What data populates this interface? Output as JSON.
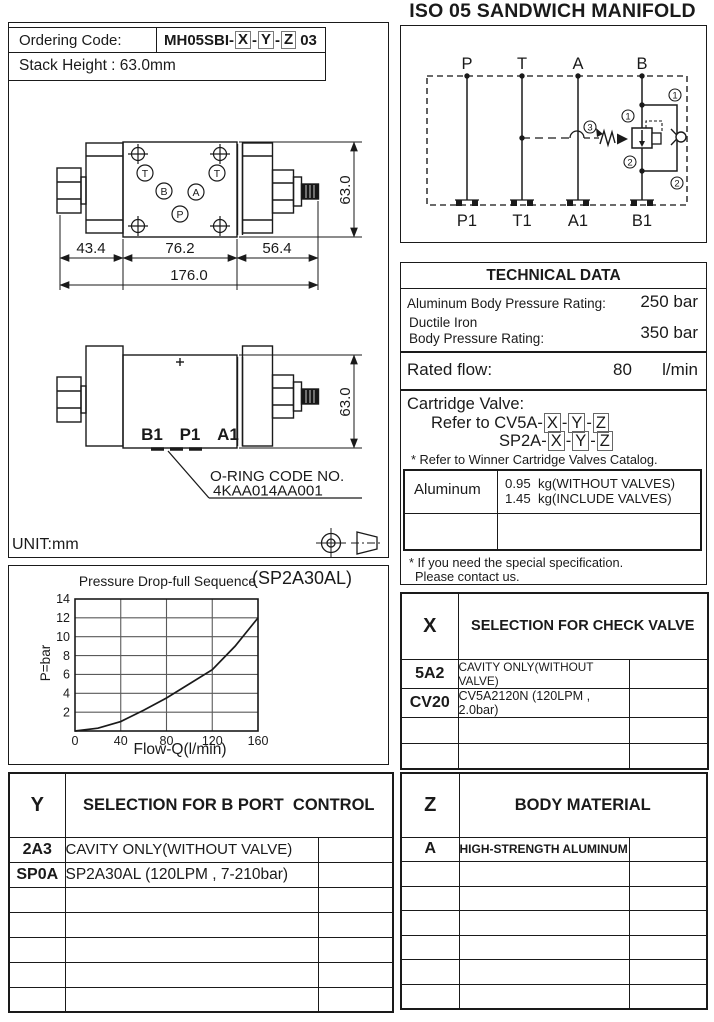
{
  "colors": {
    "ink": "#1a1a1a",
    "grid_line": "#5a5a5a"
  },
  "title": "ISO 05 SANDWICH MANIFOLD",
  "unit_label": "UNIT:mm",
  "codes": {
    "x": "X",
    "y": "Y",
    "z": "Z",
    "sep": "-"
  },
  "ordering": {
    "label": "Ordering Code:",
    "prefix": "MH05SBI-",
    "suffix": "03",
    "stack_height": "Stack Height : 63.0mm"
  },
  "schematic": {
    "top_ports": [
      "P",
      "T",
      "A",
      "B"
    ],
    "bottom_ports": [
      "P1",
      "T1",
      "A1",
      "B1"
    ],
    "callout_1": "1",
    "callout_2": "2",
    "callout_3": "3"
  },
  "drawing_top": {
    "port_t_left": "T",
    "port_t_right": "T",
    "port_b": "B",
    "port_a": "A",
    "port_p": "P",
    "dim_left": "43.4",
    "dim_mid": "76.2",
    "dim_right": "56.4",
    "dim_total": "176.0",
    "dim_height": "63.0"
  },
  "drawing_front": {
    "port_b1": "B1",
    "port_p1": "P1",
    "port_a1": "A1",
    "dim_height": "63.0",
    "oring_label": "O-RING CODE NO.",
    "oring_code": "4KAA014AA001"
  },
  "technical_data": {
    "title": "TECHNICAL DATA",
    "row1_label": "Aluminum Body Pressure Rating:",
    "row1_value": "250 bar",
    "row2_label_line1": "Ductile Iron",
    "row2_label_line2": "Body Pressure Rating:",
    "row2_value": "350 bar",
    "row3_label": "Rated flow:",
    "row3_value": "80",
    "row3_unit": "l/min",
    "cartridge_label": "Cartridge Valve:",
    "cartridge_ref1_prefix": "Refer to CV5A-",
    "cartridge_ref2_prefix": "SP2A-",
    "note_catalog": "* Refer to Winner Cartridge Valves Catalog.",
    "weight_material": "Aluminum",
    "weight_line1": "0.95  kg(WITHOUT VALVES)",
    "weight_line2": "1.45  kg(INCLUDE VALVES)",
    "note_special_line1": "* If you need the special specification.",
    "note_special_line2": "Please contact us."
  },
  "chart_data": {
    "type": "line",
    "title": "Pressure Drop-full Sequence",
    "annotation": "(SP2A30AL)",
    "xlabel": "Flow-Q(l/min)",
    "ylabel": "P=bar",
    "x": [
      0,
      20,
      40,
      60,
      80,
      100,
      120,
      140,
      160
    ],
    "y": [
      0,
      0.3,
      1.0,
      2.2,
      3.5,
      5.0,
      6.5,
      9.0,
      12.0
    ],
    "xlim": [
      0,
      160
    ],
    "ylim": [
      0,
      14
    ],
    "xticks": [
      0,
      40,
      80,
      120,
      160
    ],
    "yticks": [
      2,
      4,
      6,
      8,
      10,
      12,
      14
    ],
    "grid": true,
    "legend": false
  },
  "selection_x": {
    "code": "X",
    "title": "SELECTION FOR CHECK VALVE",
    "rows": [
      {
        "code": "5A2",
        "desc": "CAVITY ONLY(WITHOUT VALVE)",
        "extra": ""
      },
      {
        "code": "CV20",
        "desc": "CV5A2120N (120LPM , 2.0bar)",
        "extra": ""
      },
      {
        "code": "",
        "desc": "",
        "extra": ""
      },
      {
        "code": "",
        "desc": "",
        "extra": ""
      }
    ]
  },
  "selection_y": {
    "code": "Y",
    "title": "SELECTION FOR B PORT  CONTROL",
    "rows": [
      {
        "code": "2A3",
        "desc": "CAVITY ONLY(WITHOUT VALVE)",
        "extra": ""
      },
      {
        "code": "SP0A",
        "desc": "SP2A30AL (120LPM , 7-210bar)",
        "extra": ""
      },
      {
        "code": "",
        "desc": "",
        "extra": ""
      },
      {
        "code": "",
        "desc": "",
        "extra": ""
      },
      {
        "code": "",
        "desc": "",
        "extra": ""
      },
      {
        "code": "",
        "desc": "",
        "extra": ""
      },
      {
        "code": "",
        "desc": "",
        "extra": ""
      }
    ]
  },
  "selection_z": {
    "code": "Z",
    "title": "BODY MATERIAL",
    "rows": [
      {
        "code": "A",
        "desc": "HIGH-STRENGTH ALUMINUM",
        "extra": ""
      },
      {
        "code": "",
        "desc": "",
        "extra": ""
      },
      {
        "code": "",
        "desc": "",
        "extra": ""
      },
      {
        "code": "",
        "desc": "",
        "extra": ""
      },
      {
        "code": "",
        "desc": "",
        "extra": ""
      },
      {
        "code": "",
        "desc": "",
        "extra": ""
      },
      {
        "code": "",
        "desc": "",
        "extra": ""
      }
    ]
  }
}
